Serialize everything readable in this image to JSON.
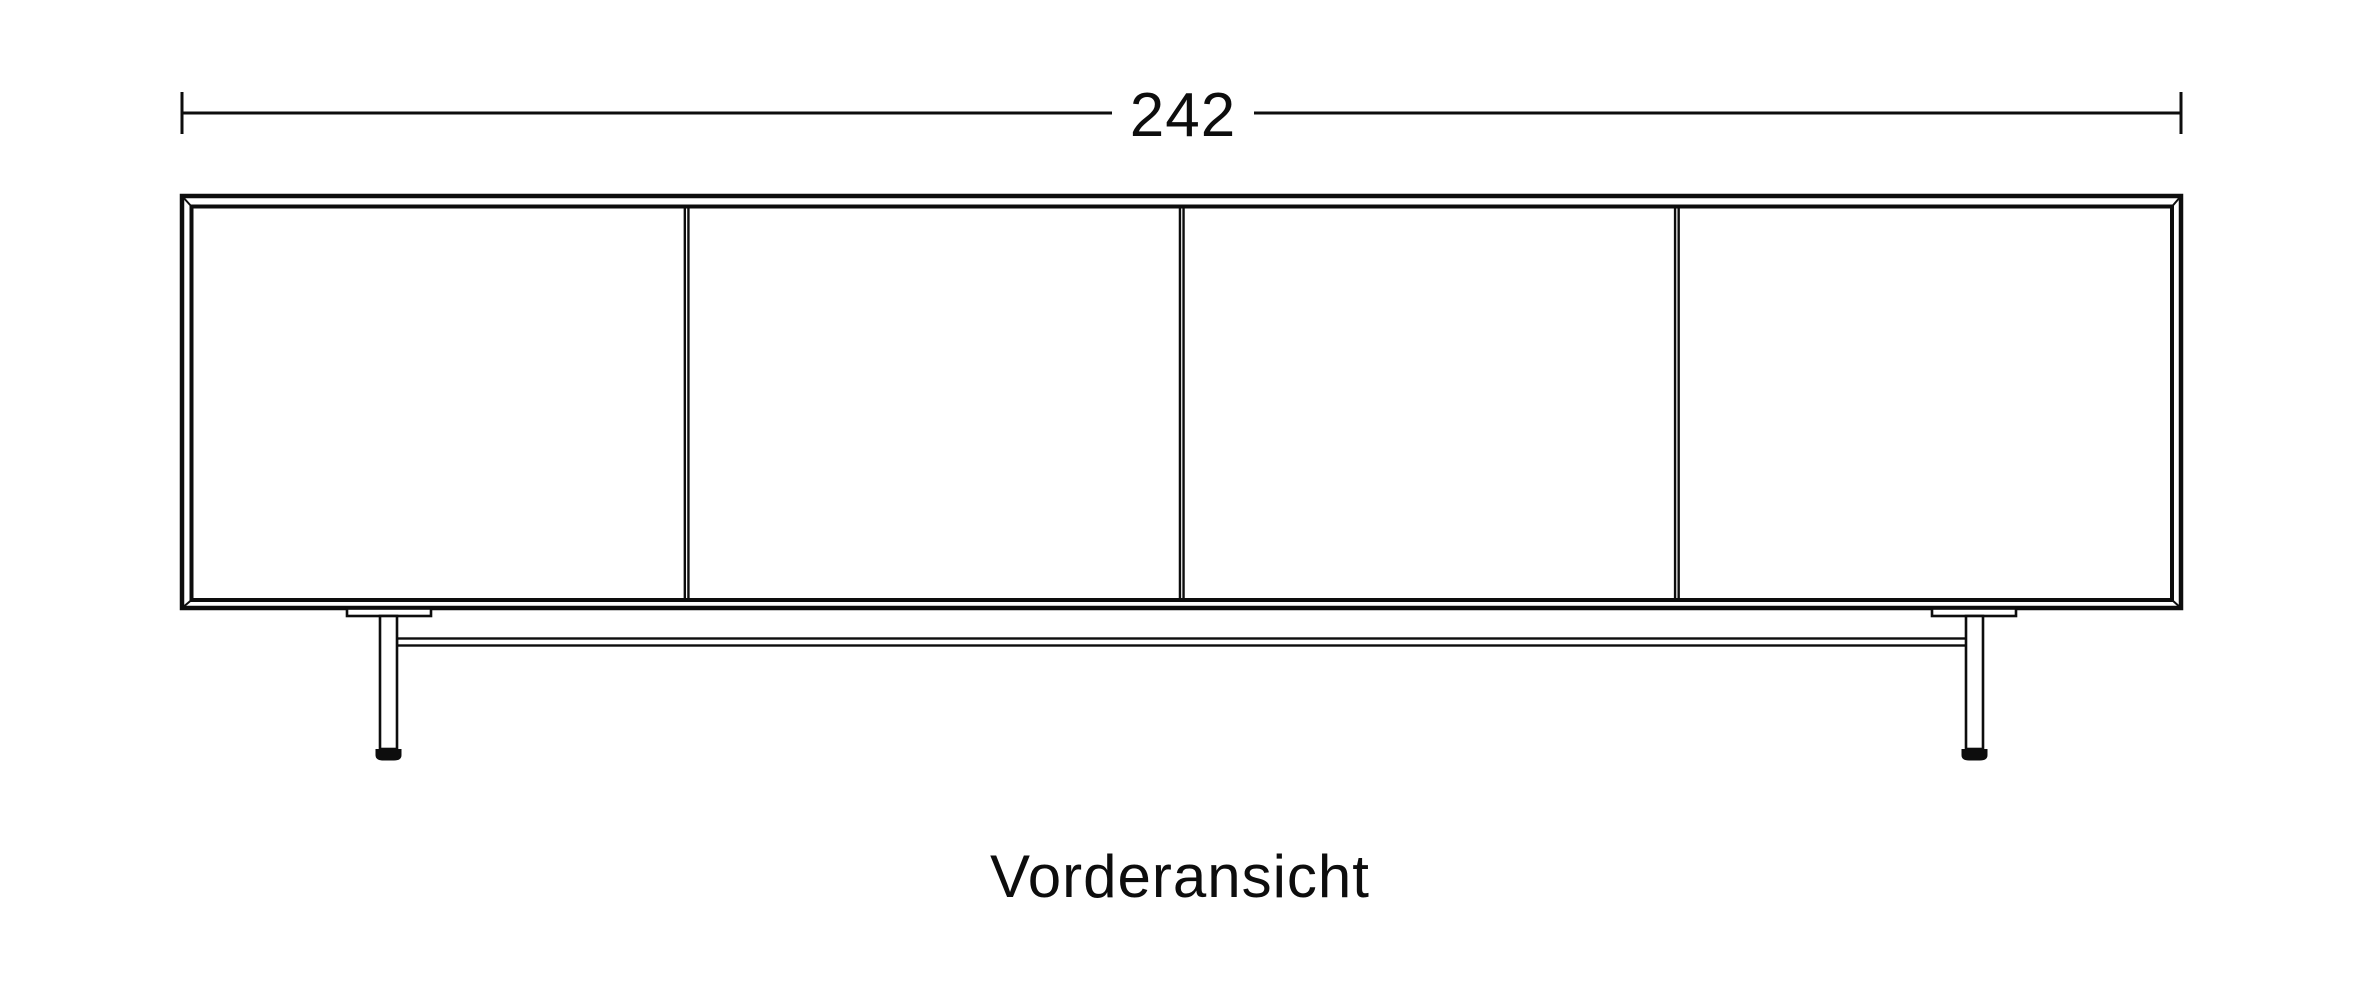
{
  "dimension": {
    "value": "242"
  },
  "caption": {
    "label": "Vorderansicht"
  },
  "cabinet": {
    "door_count": 4
  },
  "colors": {
    "line": "#0d0d0d",
    "background": "#ffffff"
  }
}
